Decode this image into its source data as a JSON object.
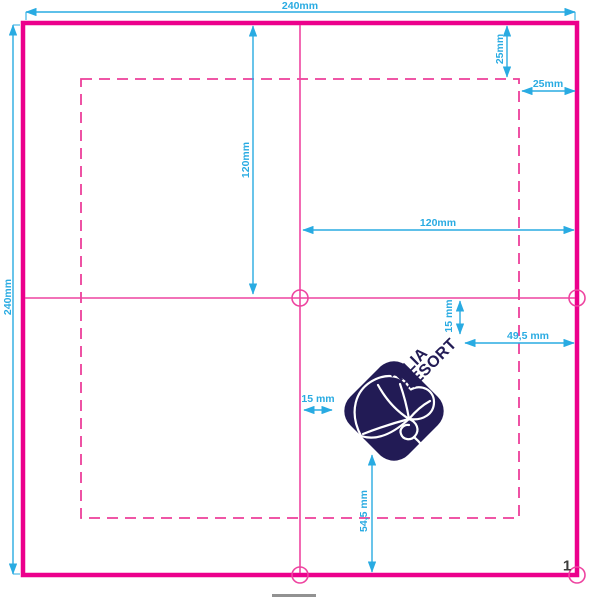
{
  "page": {
    "number": "1"
  },
  "colors": {
    "cutline_magenta": "#ec008c",
    "guide_pink": "#ee44a0",
    "dashed_pink": "#ed3f9a",
    "dimension_cyan": "#29abe2",
    "logo_navy": "#221b55",
    "page_number_gray": "#3c3c3b",
    "bar_gray": "#929292"
  },
  "dimensions": {
    "sheet_width": "240mm",
    "sheet_height": "240mm",
    "fold_top_to_center": "120mm",
    "center_to_right_edge": "120mm",
    "inset_top": "25mm",
    "inset_right": "25mm",
    "logo_top_offset": "15 mm",
    "logo_left_offset": "15 mm",
    "logo_right_offset": "49,5 mm",
    "logo_bottom_offset": "54,5 mm"
  },
  "logo": {
    "line1": "TILIA",
    "line2": "RESORT"
  }
}
